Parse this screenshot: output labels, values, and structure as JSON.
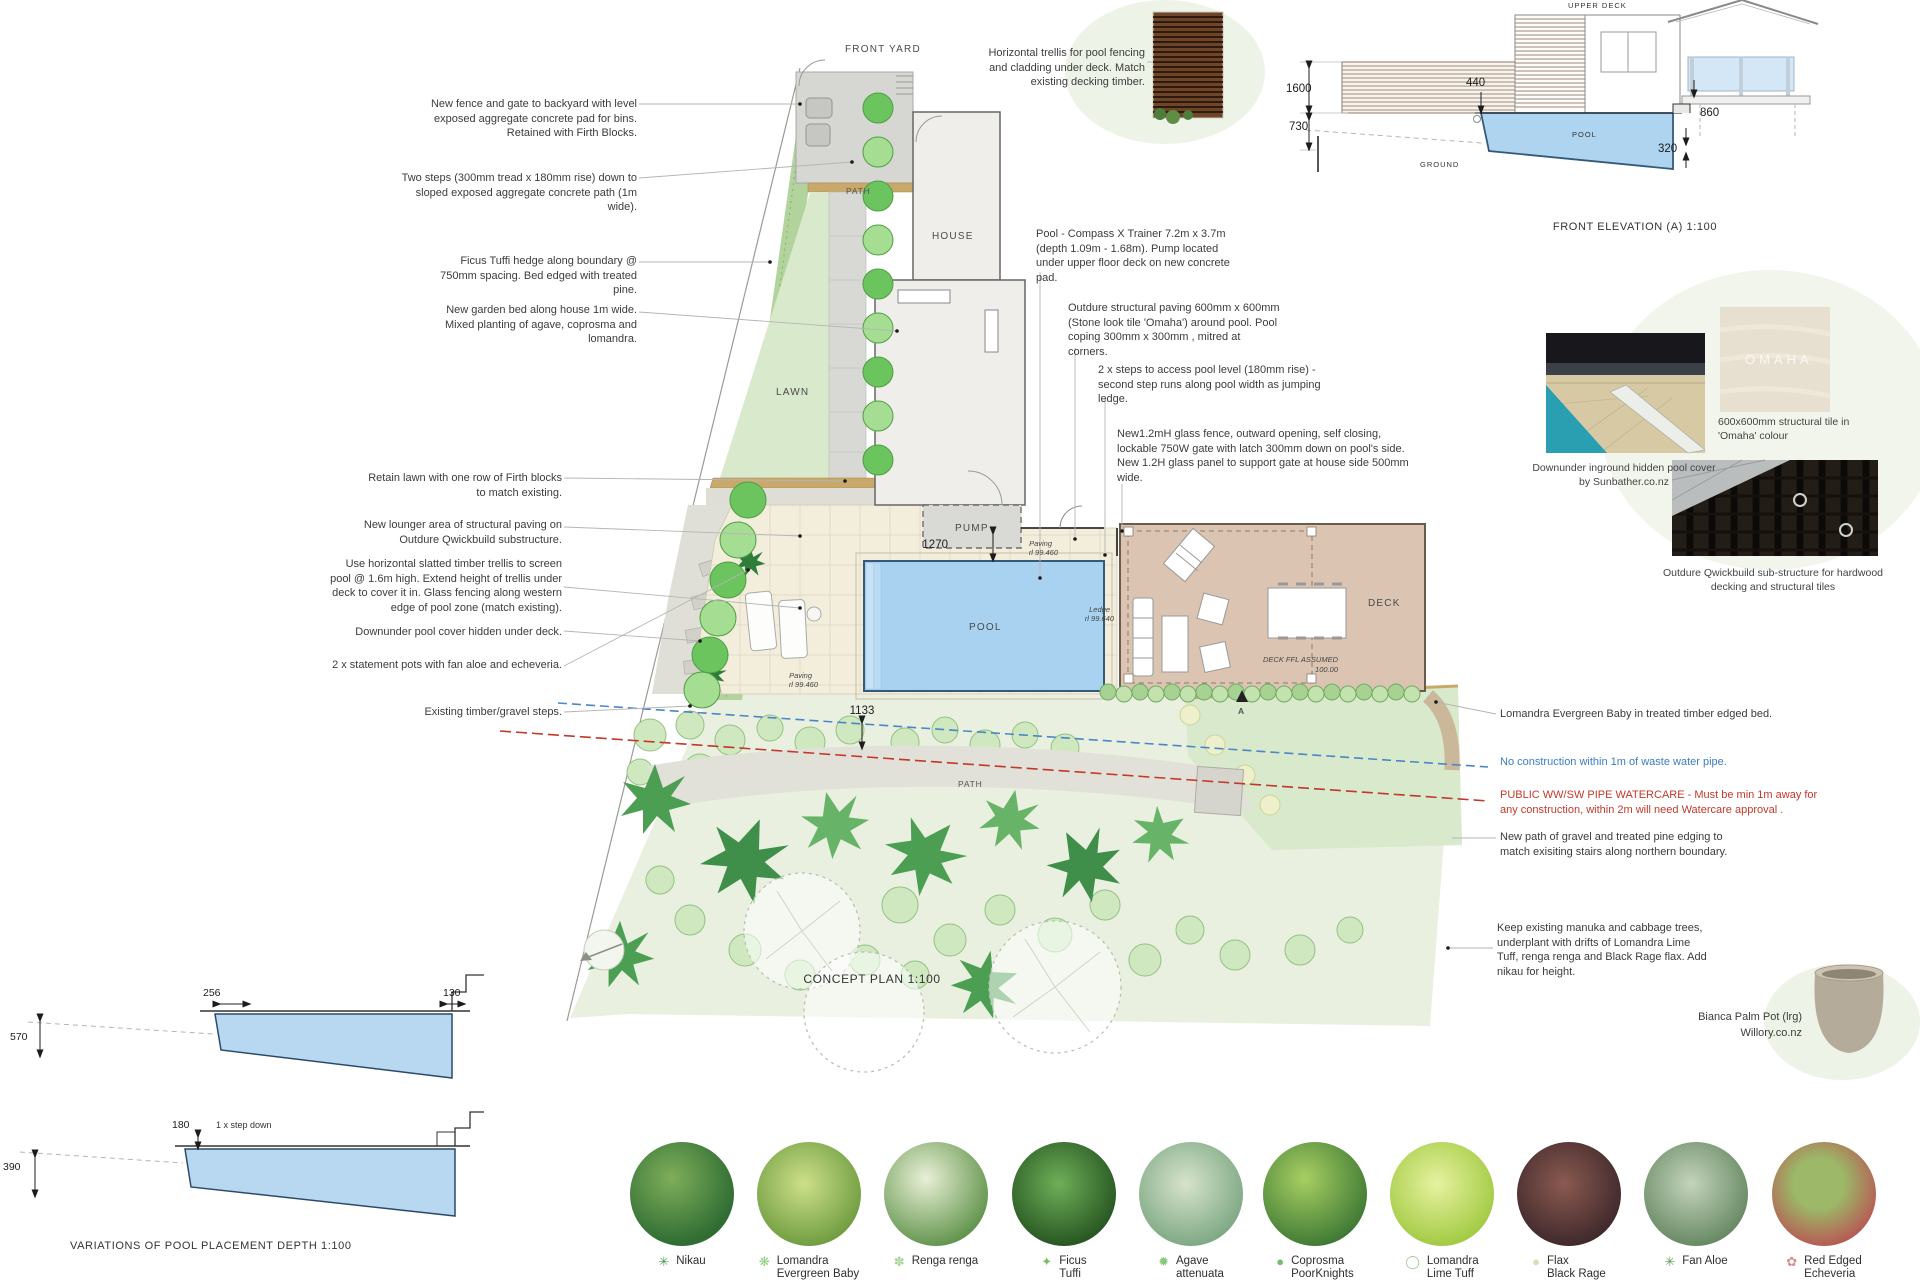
{
  "titles": {
    "concept": "CONCEPT PLAN 1:100",
    "elevation": "FRONT ELEVATION (A) 1:100",
    "variations": "VARIATIONS OF POOL PLACEMENT DEPTH 1:100"
  },
  "plan": {
    "front_yard": "FRONT YARD",
    "path_top": "PATH",
    "house": "HOUSE",
    "lawn": "LAWN",
    "pump": "PUMP",
    "pool": "POOL",
    "deck": "DECK",
    "path_lower": "PATH",
    "section_a": "A",
    "paving_label": "Paving",
    "paving_rl": "rl 99.460",
    "paving2_label": "Paving",
    "paving2_rl": "rl 99.460",
    "ledge_label": "Ledge",
    "ledge_rl": "rl 99.640",
    "deck_ffl": "DECK FFL ASSUMED",
    "deck_ffl_val": "100.00",
    "dim_1270": "1270",
    "dim_1133": "1133"
  },
  "elevation": {
    "upper_deck": "UPPER DECK",
    "pool": "POOL",
    "ground": "GROUND",
    "dim_1600": "1600",
    "dim_730": "730",
    "dim_440": "440",
    "dim_860": "860",
    "dim_320": "320"
  },
  "sections": {
    "dim_256": "256",
    "dim_130": "130",
    "dim_570": "570",
    "dim_180": "180",
    "dim_390": "390",
    "step_note": "1 x step down"
  },
  "annotations_left": [
    "New fence and gate to backyard with level exposed aggregate concrete pad for bins.  Retained with Firth Blocks.",
    "Two steps (300mm tread x 180mm rise) down to sloped exposed aggregate concrete path (1m wide).",
    "Ficus Tuffi hedge along boundary @ 750mm spacing.  Bed edged with treated pine.",
    "New garden bed along house 1m wide.  Mixed planting of agave, coprosma and lomandra.",
    "Retain lawn with one row of Firth blocks to match existing.",
    "New lounger area of structural paving on Outdure Qwickbuild substructure.",
    "Use horizontal slatted timber trellis to screen pool @ 1.6m high.  Extend height of trellis under deck to cover it in.  Glass fencing along western edge of pool zone (match existing).",
    "Downunder pool cover hidden under deck.",
    "2 x statement pots with fan aloe and echeveria.",
    "Existing timber/gravel steps."
  ],
  "annotations_center": {
    "trellis": "Horizontal trellis for pool fencing and cladding under deck.  Match existing decking timber.",
    "pool": "Pool - Compass X Trainer 7.2m x 3.7m (depth 1.09m - 1.68m).  Pump located under upper floor deck on new concrete pad.",
    "paving": "Outdure structural paving 600mm x 600mm (Stone look tile 'Omaha') around pool.  Pool coping 300mm x 300mm , mitred at corners.",
    "steps": "2 x steps to access pool level (180mm rise) - second step runs along pool width as jumping ledge.",
    "fence": "New1.2mH glass fence, outward opening, self closing, lockable 750W gate with latch 300mm down on pool's side. New 1.2H glass panel to support gate at house side 500mm wide."
  },
  "annotations_right": [
    "Lomandra Evergreen Baby in treated timber edged bed.",
    "No construction within 1m of waste water pipe.",
    "PUBLIC WW/SW PIPE WATERCARE - Must be min 1m away for any construction,  within 2m will need Watercare approval .",
    "New path of gravel and treated pine edging to match exisiting stairs along northern boundary.",
    "Keep existing manuka and cabbage trees, underplant with drifts of Lomandra Lime Tuff, renga renga and Black Rage flax.  Add nikau for height."
  ],
  "captions": {
    "downunder": "Downunder inground hidden pool cover by Sunbather.co.nz",
    "omaha": "600x600mm structural tile in 'Omaha' colour",
    "omaha_tile_text": "OMAHA",
    "qwickbuild": "Outdure Qwickbuild sub-structure for hardwood decking and structural tiles",
    "pot_line1": "Bianca Palm Pot (lrg)",
    "pot_line2": "Willory.co.nz"
  },
  "legend": {
    "items": [
      {
        "name": "Nikau",
        "line2": "",
        "icon": "✳"
      },
      {
        "name": "Lomandra",
        "line2": "Evergreen Baby",
        "icon": "❋"
      },
      {
        "name": "Renga renga",
        "line2": "",
        "icon": "✽"
      },
      {
        "name": "Ficus",
        "line2": "Tuffi",
        "icon": "✦"
      },
      {
        "name": "Agave",
        "line2": "attenuata",
        "icon": "✹"
      },
      {
        "name": "Coprosma",
        "line2": "PoorKnights",
        "icon": "●"
      },
      {
        "name": "Lomandra",
        "line2": "Lime Tuff",
        "icon": "◯"
      },
      {
        "name": "Flax",
        "line2": "Black Rage",
        "icon": "●"
      },
      {
        "name": "Fan Aloe",
        "line2": "",
        "icon": "✳"
      },
      {
        "name": "Red Edged",
        "line2": "Echeveria",
        "icon": "✿"
      }
    ]
  },
  "colors": {
    "pool_water": "#a9d2f0",
    "deck_timber": "#dbc5b2",
    "lawn": "#d9e9cb",
    "paving": "#f3eddc",
    "pipe_public_watercare": "#c0392b",
    "pipe_waste_water": "#3b7ec0"
  }
}
